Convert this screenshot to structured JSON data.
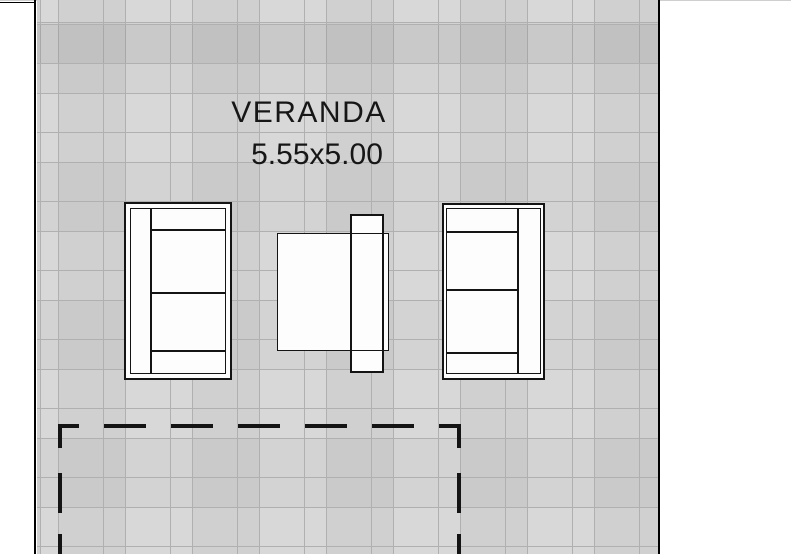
{
  "plan": {
    "room_label": "VERANDA",
    "room_dimensions": "5.55x5.00",
    "boundary_style": "dashed rectangle, open at bottom edge of image"
  },
  "furniture": [
    {
      "id": "sofa-left",
      "kind": "two-seat sofa, backrest on left side"
    },
    {
      "id": "coffee-table",
      "kind": "square table"
    },
    {
      "id": "side-table",
      "kind": "narrow side table overlapping table right edge"
    },
    {
      "id": "sofa-right",
      "kind": "two-seat sofa, backrest on right side"
    }
  ],
  "colors": {
    "paper": "#ffffff",
    "floor_tile": "#d6d6d6",
    "tile_line": "#b0b0b0",
    "wall_line": "#000000",
    "furniture_outline": "#141414",
    "furniture_fill": "#fdfdfd",
    "dashed_line": "#141414"
  }
}
